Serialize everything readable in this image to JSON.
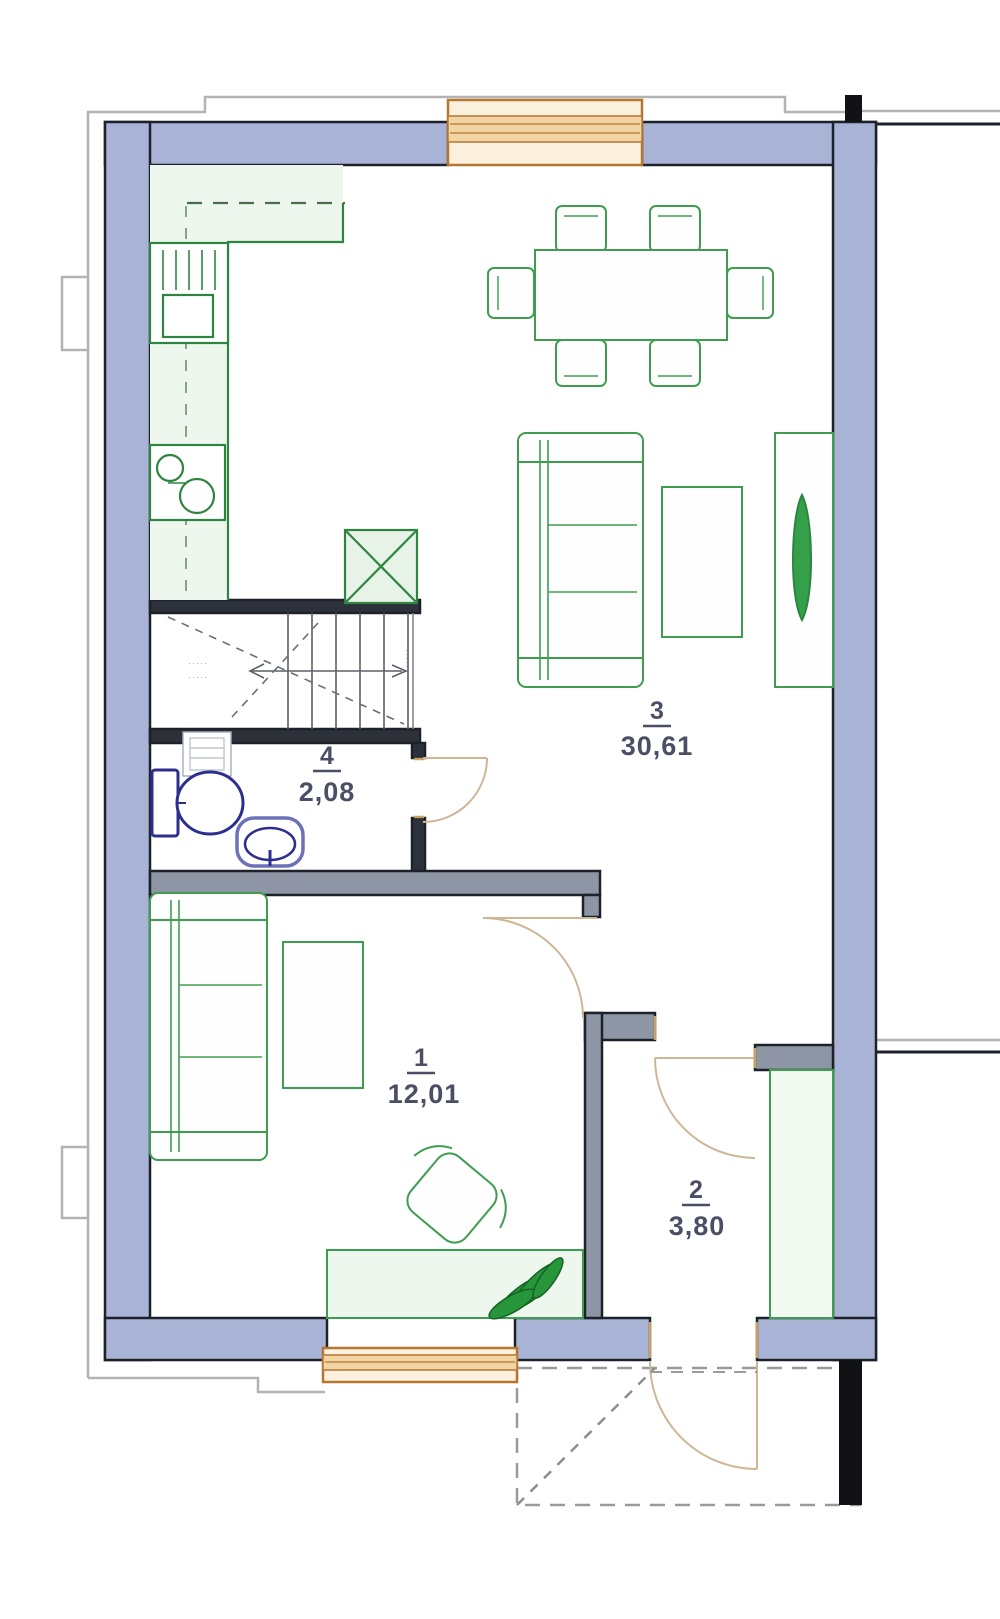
{
  "rooms": {
    "living": {
      "number": "3",
      "area": "30,61"
    },
    "bathroom": {
      "number": "4",
      "area": "2,08"
    },
    "bedroom": {
      "number": "1",
      "area": "12,01"
    },
    "hall": {
      "number": "2",
      "area": "3,80"
    }
  },
  "stairs": {
    "left_note": "·····",
    "right_note": "·····"
  },
  "colors": {
    "wall_fill": "#a9b3d6",
    "wall_core": "#8e96a6",
    "wall_edge": "#1d222a",
    "furniture_green": "#3f9d50",
    "appliance_green": "#2e8540",
    "fixture_blue": "#2d2f8f",
    "window_frame": "#b5762f",
    "window_glass": "#f2d4a4",
    "door_arc": "#cdb795",
    "label": "#4b4f66",
    "outline_gray": "#b3b3b3",
    "plant_green": "#1e8a2e"
  }
}
